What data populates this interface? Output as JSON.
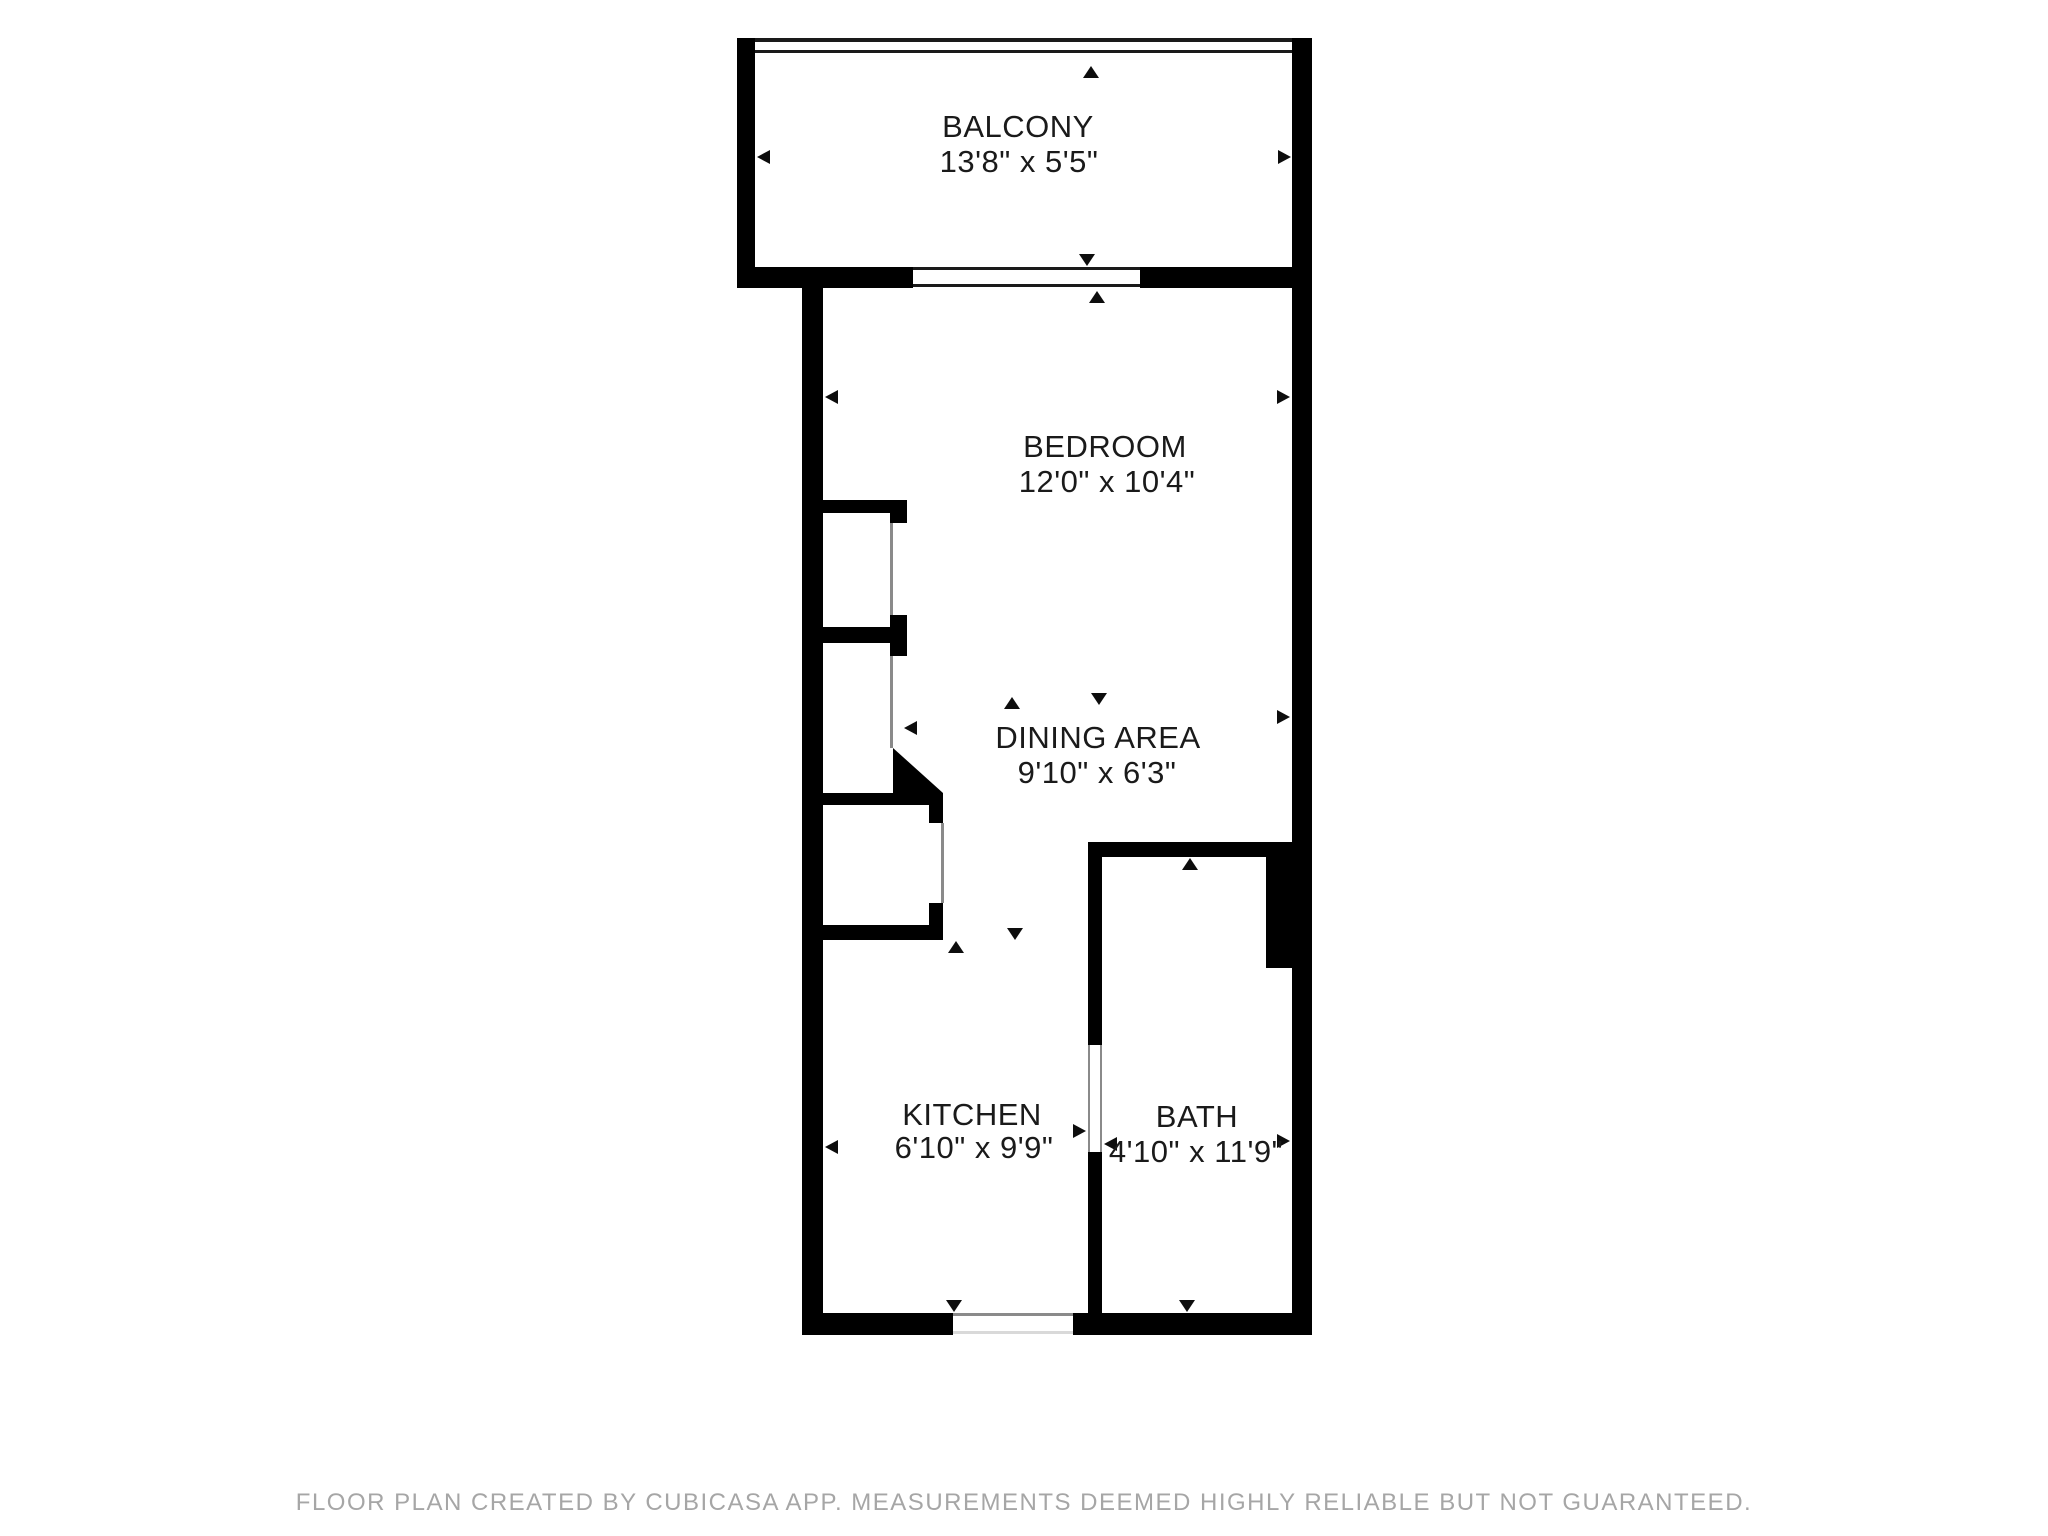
{
  "rooms": [
    {
      "id": "balcony",
      "name": "BALCONY",
      "dimensions": "13'8\" x 5'5\""
    },
    {
      "id": "bedroom",
      "name": "BEDROOM",
      "dimensions": "12'0\" x 10'4\""
    },
    {
      "id": "dining-area",
      "name": "DINING AREA",
      "dimensions": "9'10\" x 6'3\""
    },
    {
      "id": "kitchen",
      "name": "KITCHEN",
      "dimensions": "6'10\" x 9'9\""
    },
    {
      "id": "bath",
      "name": "BATH",
      "dimensions": "4'10\" x 11'9\""
    }
  ],
  "footer": {
    "disclaimer": "FLOOR PLAN CREATED BY CUBICASA APP. MEASUREMENTS DEEMED HIGHLY RELIABLE BUT NOT GUARANTEED."
  },
  "colors": {
    "wall": "#000000",
    "background": "#ffffff",
    "label_text": "#1a1a1a",
    "footer_text": "#a6a6a6",
    "door_jamb_line": "#8a8a8a"
  }
}
